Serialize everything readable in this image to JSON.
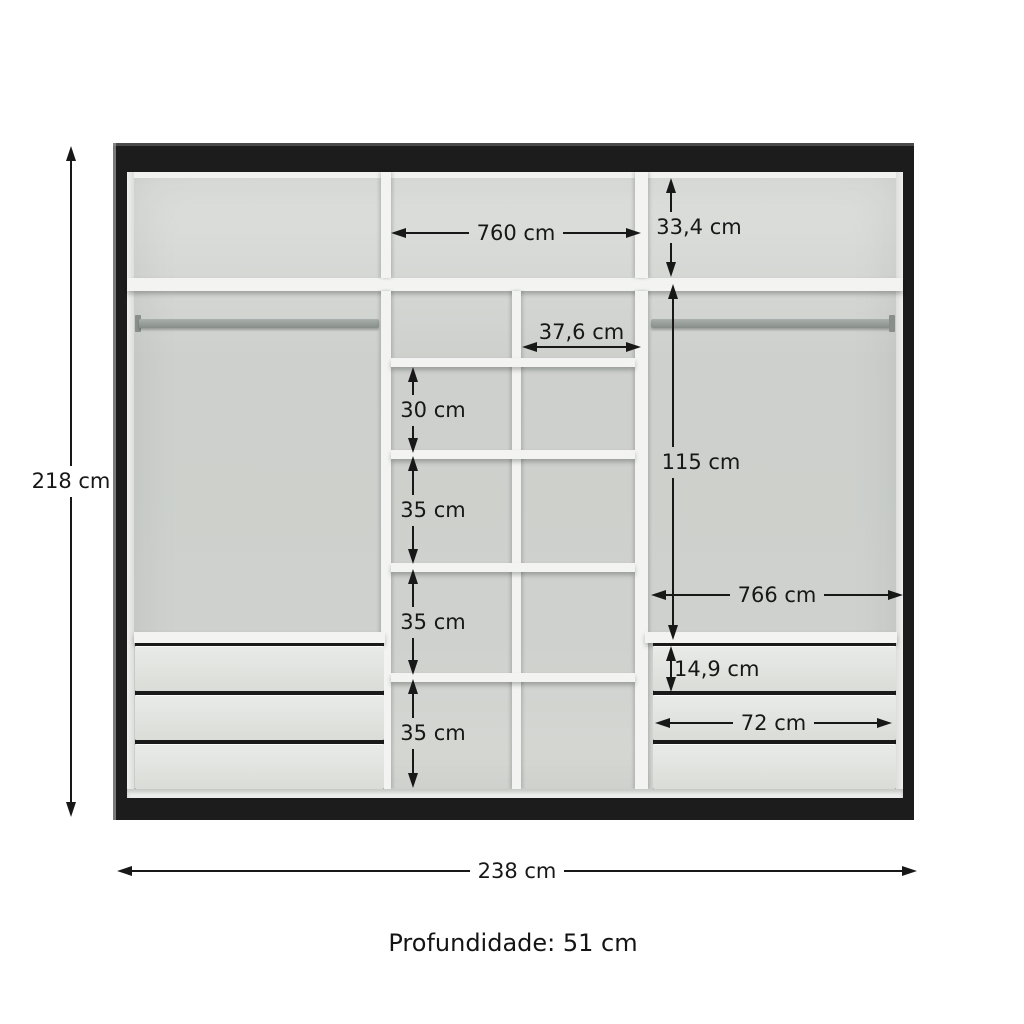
{
  "diagram": {
    "type": "wardrobe-interior-dimensions",
    "colors": {
      "frame": "#1c1c1c",
      "back_panel": "#cfd2ce",
      "panels_white": "#f3f4f2",
      "drawer_front": "#e2e4e1",
      "rod": "#9aa09d",
      "annotation": "#181818",
      "background": "#ffffff"
    },
    "dims": {
      "overall_height": "218 cm",
      "overall_width": "238 cm",
      "depth_note": "Profundidade: 51 cm",
      "top_middle_width": "760 cm",
      "top_section_height": "33,4 cm",
      "middle_cubby_width": "37,6 cm",
      "middle_row1_height": "30 cm",
      "middle_row2_height": "35 cm",
      "middle_row3_height": "35 cm",
      "middle_row4_height": "35 cm",
      "right_section_height": "115 cm",
      "right_section_width": "766 cm",
      "drawer_front_height": "14,9 cm",
      "drawer_width": "72 cm"
    }
  }
}
